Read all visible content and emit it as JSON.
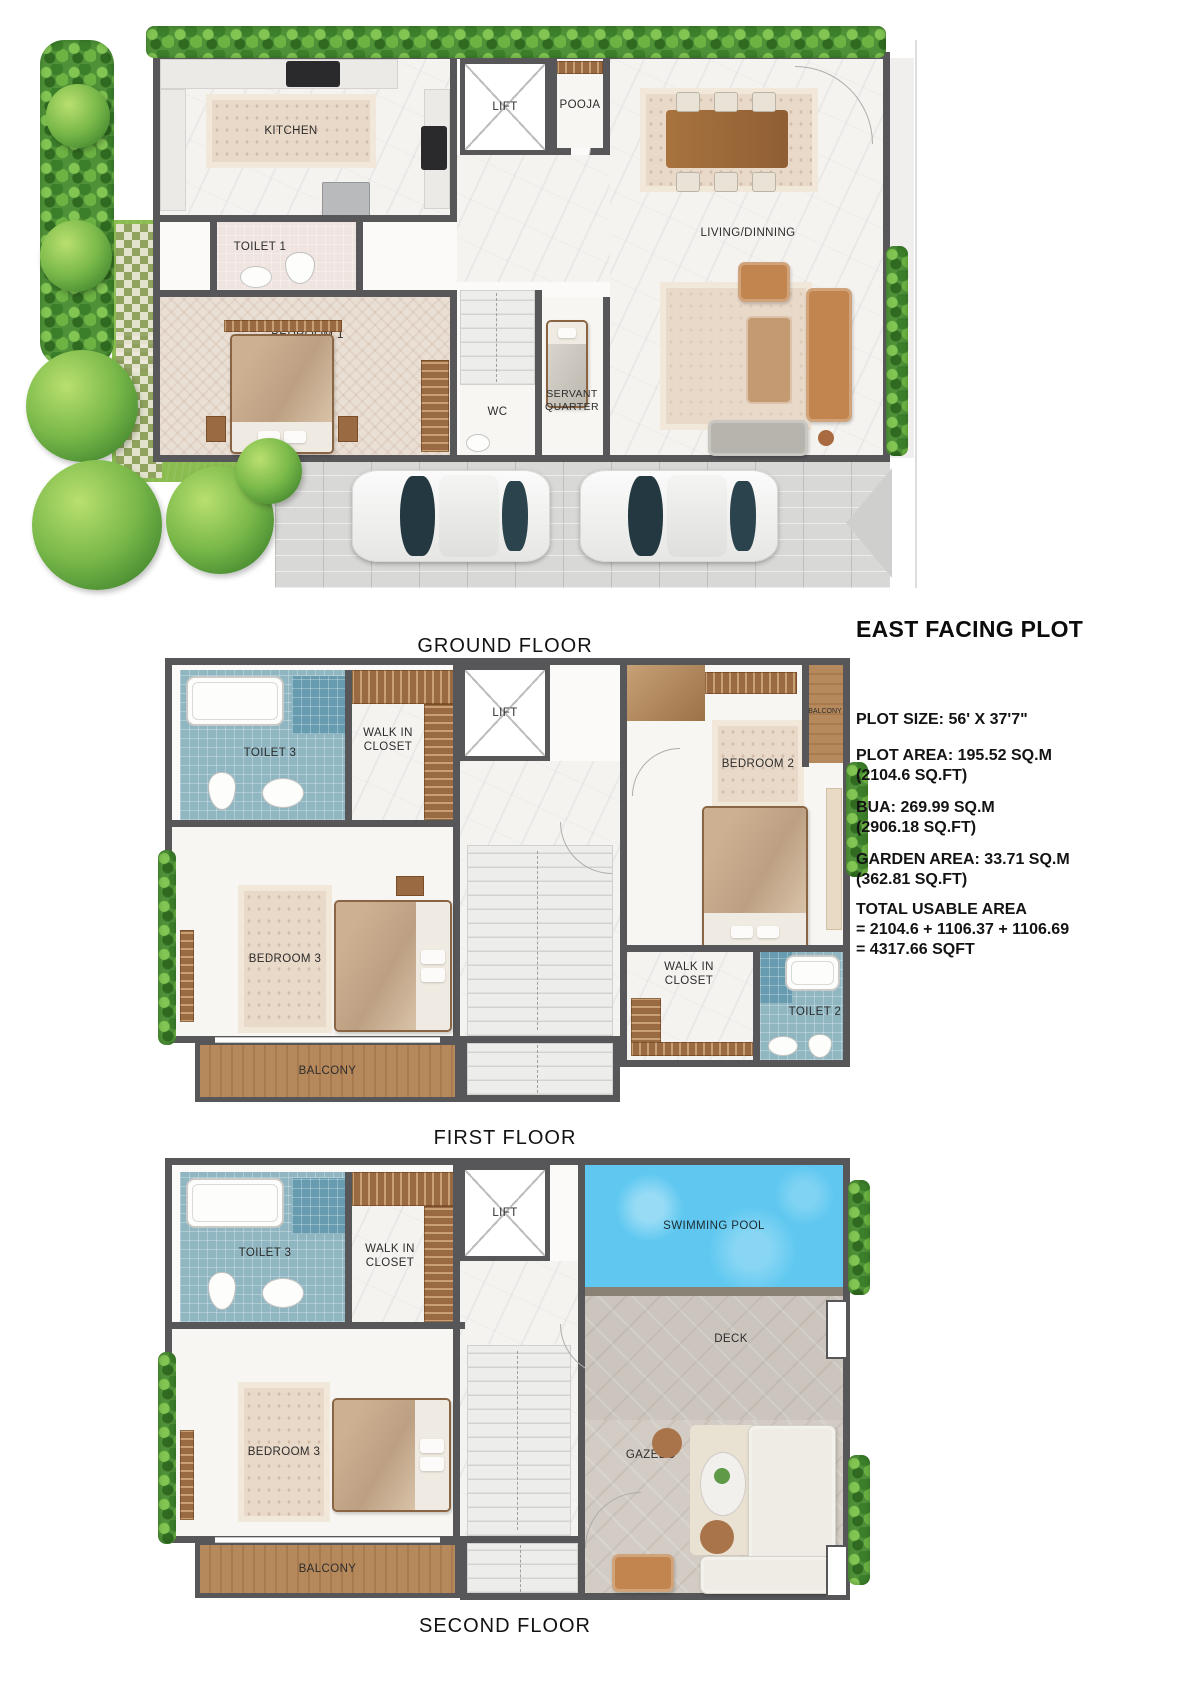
{
  "floors": {
    "ground": {
      "label": "GROUND FLOOR",
      "rooms": {
        "kitchen": "KITCHEN",
        "lift": "LIFT",
        "pooja": "POOJA",
        "living_dining": "LIVING/DINNING",
        "toilet_1": "TOILET 1",
        "bedroom_1": "BEDROOM 1",
        "wc": "WC",
        "servant_quarter": "SERVANT QUARTER"
      }
    },
    "first": {
      "label": "FIRST FLOOR",
      "rooms": {
        "toilet_3": "TOILET 3",
        "walk_in_closet_left": "WALK IN CLOSET",
        "lift": "LIFT",
        "bedroom_3": "BEDROOM 3",
        "balcony_left": "BALCONY",
        "bedroom_2": "BEDROOM 2",
        "balcony_right": "BALCONY",
        "walk_in_closet_right": "WALK IN CLOSET",
        "toilet_2": "TOILET 2"
      }
    },
    "second": {
      "label": "SECOND FLOOR",
      "rooms": {
        "toilet_3": "TOILET 3",
        "walk_in_closet": "WALK IN CLOSET",
        "lift": "LIFT",
        "swimming_pool": "SWIMMING POOL",
        "deck": "DECK",
        "bedroom_3": "BEDROOM 3",
        "gazebo": "GAZEBO",
        "balcony": "BALCONY"
      }
    }
  },
  "info_panel": {
    "title": "EAST FACING PLOT",
    "plot_size": "PLOT SIZE: 56' X 37'7\"",
    "plot_area_line1": "PLOT AREA: 195.52 SQ.M",
    "plot_area_line2": "(2104.6 SQ.FT)",
    "bua_line1": "BUA: 269.99 SQ.M",
    "bua_line2": "(2906.18 SQ.FT)",
    "garden_line1": "GARDEN AREA: 33.71 SQ.M",
    "garden_line2": "(362.81 SQ.FT)",
    "total_line1": "TOTAL USABLE AREA",
    "total_line2": "= 2104.6 + 1106.37 + 1106.69",
    "total_line3": "= 4317.66 SQFT"
  },
  "colors": {
    "wall": "#57575a",
    "pool": "#60c8f0",
    "hedge": "#4f9138",
    "toilet_tile": "#8fb6c1",
    "closet_wood": "#9a6a42",
    "balcony_wood": "#b6895c"
  }
}
